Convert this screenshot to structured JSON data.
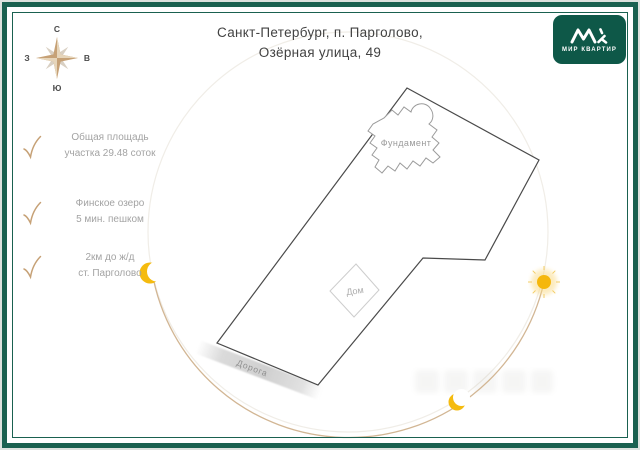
{
  "header": {
    "title_line1": "Санкт-Петербург, п. Парголово,",
    "title_line2": "Озёрная улица, 49"
  },
  "logo": {
    "caption": "МИР КВАРТИР",
    "bg_color": "#0e5848",
    "monogram": "МК"
  },
  "compass": {
    "north": "С",
    "south": "Ю",
    "west": "З",
    "east": "В",
    "star_color": "#c6a176"
  },
  "features": [
    {
      "line1": "Общая площадь",
      "line2": "участка 29.48 соток"
    },
    {
      "line1": "Финское озеро",
      "line2": "5 мин. пешком"
    },
    {
      "line1": "2км до ж/д",
      "line2": "ст. Парголово"
    }
  ],
  "plan": {
    "road_label": "Дорога",
    "foundation_label": "Фундамент",
    "house_label": "Дом",
    "accent_yellow": "#f5b70d",
    "arc_color": "#d2b694",
    "frame_green": "#1a6150",
    "outline_color": "#4a4a4a"
  }
}
